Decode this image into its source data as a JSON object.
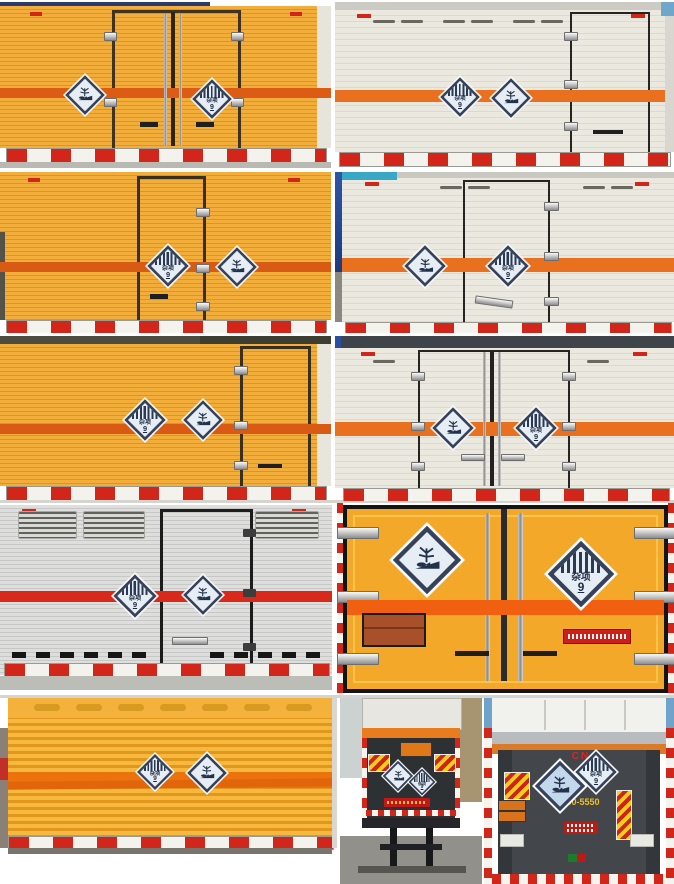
{
  "collage": {
    "layout": "5-row photo grid of hazardous-goods box truck rear views",
    "photos": [
      {
        "id": "r1-left",
        "body": "yellow-corrugated",
        "doors": "double-center",
        "placards": [
          "environment",
          "class9"
        ]
      },
      {
        "id": "r1-right",
        "body": "white-box",
        "doors": "single-right",
        "placards": [
          "class9",
          "environment"
        ]
      },
      {
        "id": "r2-left",
        "body": "yellow-corrugated",
        "doors": "single-center",
        "placards": [
          "class9",
          "environment"
        ]
      },
      {
        "id": "r2-right",
        "body": "white-box",
        "doors": "single-center",
        "placards": [
          "environment",
          "class9"
        ]
      },
      {
        "id": "r3-left",
        "body": "yellow-corrugated",
        "doors": "single-right",
        "placards": [
          "class9",
          "environment"
        ]
      },
      {
        "id": "r3-right",
        "body": "white-box",
        "doors": "double-center",
        "placards": [
          "environment",
          "class9"
        ]
      },
      {
        "id": "r4-left",
        "body": "silver-corrugated",
        "doors": "single-center",
        "placards": [
          "class9",
          "environment"
        ]
      },
      {
        "id": "r4-right",
        "body": "yellow-door-closeup",
        "doors": "double-full",
        "placards": [
          "environment",
          "class9"
        ]
      },
      {
        "id": "r5-left",
        "body": "yellow-roller-shutter",
        "doors": "roller",
        "placards": [
          "class9",
          "environment"
        ]
      },
      {
        "id": "r5-middle",
        "body": "full-truck-rear-tail-lift",
        "placards": [
          "environment",
          "class9"
        ]
      },
      {
        "id": "r5-right",
        "body": "full-truck-rear-tail-lift",
        "placards": [
          "environment",
          "class9"
        ]
      }
    ]
  },
  "placards": {
    "class9_label": "杂项",
    "class9_number": "9"
  },
  "row5_right_photo": {
    "logo": "CN",
    "phone": "-990-5550"
  },
  "colors": {
    "yellow_body": "#efa735",
    "yellow_ridge": "#dd9420",
    "white_body": "#ebe8df",
    "silver_body": "#d8d8d4",
    "stripe_orange": "#e8701f",
    "stripe_red_orange": "#dc5c16",
    "stripe_red": "#d8291b",
    "bumper_red": "#d3261a",
    "placard_navy": "#2b3a52",
    "placard_face": "#e6edf4",
    "sky_blue": "#6fa3c9",
    "phone_yellow": "#f0c01c"
  }
}
